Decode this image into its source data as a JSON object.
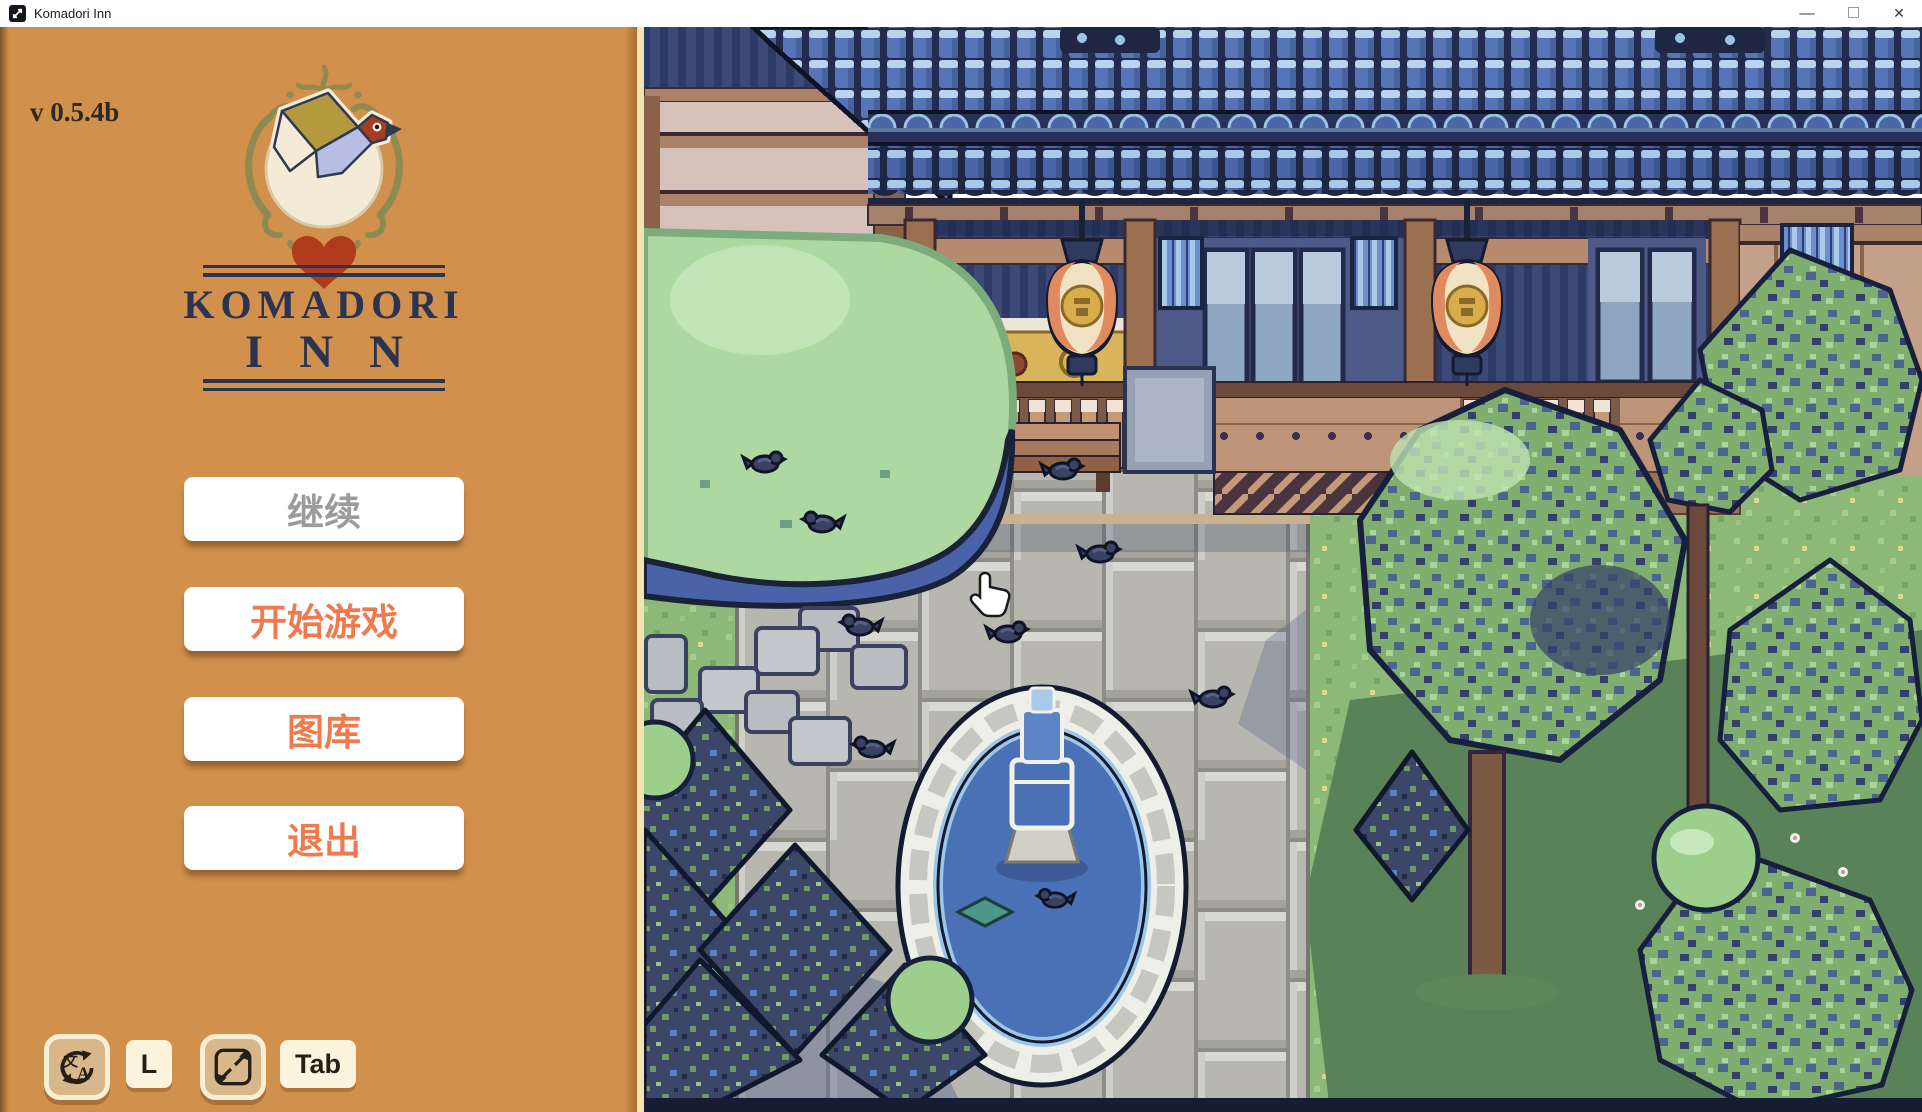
{
  "window": {
    "title": "Komadori Inn",
    "minimize_glyph": "—",
    "close_glyph": "✕"
  },
  "sidebar": {
    "version": "v 0.5.4b",
    "logo_title_line1": "KOMADORI",
    "logo_title_line2": "INN",
    "menu": [
      {
        "id": "continue",
        "label": "继续",
        "enabled": false
      },
      {
        "id": "start",
        "label": "开始游戏",
        "enabled": true
      },
      {
        "id": "gallery",
        "label": "图库",
        "enabled": true
      },
      {
        "id": "quit",
        "label": "退出",
        "enabled": true
      }
    ],
    "hotkeys": {
      "language_key": "L",
      "fullscreen_key": "Tab"
    },
    "colors": {
      "background": "#d1904c",
      "button_background": "#ffffff",
      "button_text_active": "#ee7a50",
      "button_text_disabled": "#9b9b9b",
      "title_navy": "#2a3450",
      "heart_red": "#b23a1c",
      "flourish_olive": "#8d8b52",
      "key_badge": "#fcf3de",
      "icon_button": "#d8b88a"
    }
  },
  "scene": {
    "colors": {
      "roof_blue": "#4a66a8",
      "roof_highlight": "#a9c9e9",
      "roof_outline": "#1e2644",
      "wood_light": "#c49a7c",
      "wood_mid": "#a5806b",
      "grass_green": "#8cb878",
      "path_stone": "#b7b7af",
      "hedge_green": "#aed8a2",
      "water_blue": "#4a70b5",
      "stone_white": "#eef0e8",
      "bird_navy": "#3a4263",
      "lantern_cream": "#f2e2c4",
      "lantern_salmon": "#e08a60",
      "lantern_gold": "#d9ae4a"
    }
  }
}
